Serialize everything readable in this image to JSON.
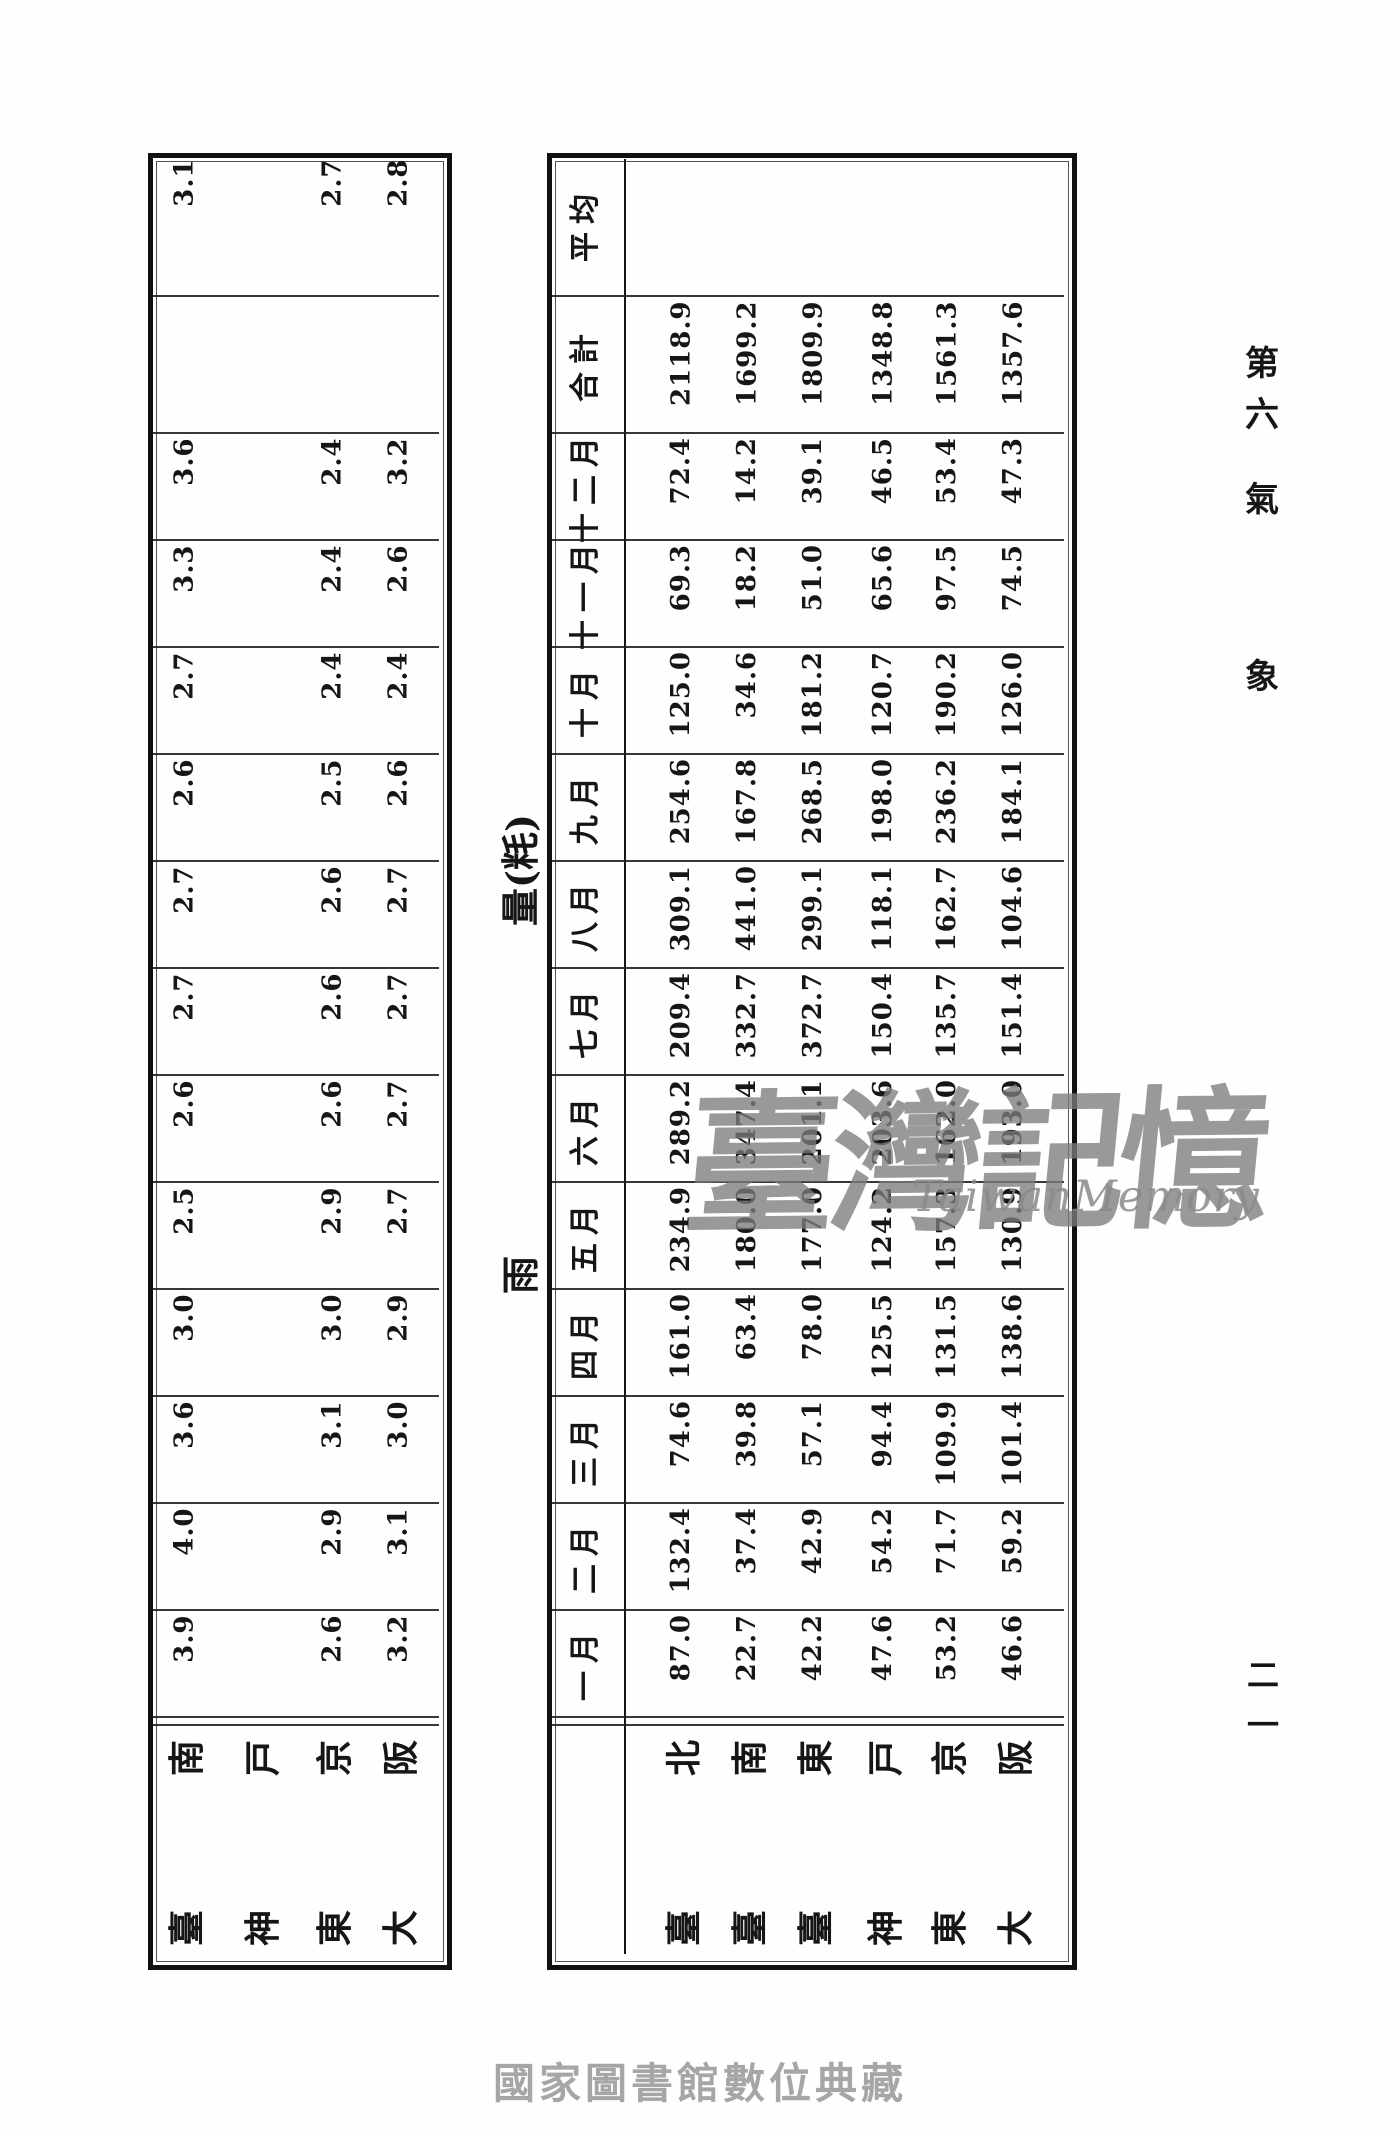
{
  "page": {
    "running_head": {
      "chars": [
        "第",
        "六",
        "氣",
        "象"
      ]
    },
    "page_number_chars": [
      "二",
      "一"
    ],
    "footer": "國家圖書館數位典藏",
    "watermark": {
      "cjk": "臺灣記憶",
      "latin": "TaiwanMemory"
    }
  },
  "section_title": {
    "lead": "雨",
    "unit": "量(粍)"
  },
  "row_labels": [
    "平均",
    "合計",
    "十二月",
    "十一月",
    "十月",
    "九月",
    "八月",
    "七月",
    "六月",
    "五月",
    "四月",
    "三月",
    "二月",
    "一月"
  ],
  "rain_table": {
    "cities": [
      [
        "臺",
        "北"
      ],
      [
        "臺",
        "南"
      ],
      [
        "臺",
        "東"
      ],
      [
        "神",
        "戸"
      ],
      [
        "東",
        "京"
      ],
      [
        "大",
        "阪"
      ]
    ],
    "values": [
      [
        "",
        "",
        "",
        "",
        "",
        ""
      ],
      [
        "2118.9",
        "1699.2",
        "1809.9",
        "1348.8",
        "1561.3",
        "1357.6"
      ],
      [
        "72.4",
        "14.2",
        "39.1",
        "46.5",
        "53.4",
        "47.3"
      ],
      [
        "69.3",
        "18.2",
        "51.0",
        "65.6",
        "97.5",
        "74.5"
      ],
      [
        "125.0",
        "34.6",
        "181.2",
        "120.7",
        "190.2",
        "126.0"
      ],
      [
        "254.6",
        "167.8",
        "268.5",
        "198.0",
        "236.2",
        "184.1"
      ],
      [
        "309.1",
        "441.0",
        "299.1",
        "118.1",
        "162.7",
        "104.6"
      ],
      [
        "209.4",
        "332.7",
        "372.7",
        "150.4",
        "135.7",
        "151.4"
      ],
      [
        "289.2",
        "347.4",
        "201.1",
        "203.6",
        "162.0",
        "193.0"
      ],
      [
        "234.9",
        "180.0",
        "177.0",
        "124.2",
        "157.3",
        "130.9"
      ],
      [
        "161.0",
        "63.4",
        "78.0",
        "125.5",
        "131.5",
        "138.6"
      ],
      [
        "74.6",
        "39.8",
        "57.1",
        "94.4",
        "109.9",
        "101.4"
      ],
      [
        "132.4",
        "37.4",
        "42.9",
        "54.2",
        "71.7",
        "59.2"
      ],
      [
        "87.0",
        "22.7",
        "42.2",
        "47.6",
        "53.2",
        "46.6"
      ]
    ]
  },
  "secondary_table": {
    "cities": [
      [
        "臺",
        "南"
      ],
      [
        "神",
        "戸"
      ],
      [
        "東",
        "京"
      ],
      [
        "大",
        "阪"
      ]
    ],
    "values": [
      [
        "3.1",
        "",
        "2.7",
        "2.8"
      ],
      [
        "",
        "",
        "",
        ""
      ],
      [
        "3.6",
        "",
        "2.4",
        "3.2"
      ],
      [
        "3.3",
        "",
        "2.4",
        "2.6"
      ],
      [
        "2.7",
        "",
        "2.4",
        "2.4"
      ],
      [
        "2.6",
        "",
        "2.5",
        "2.6"
      ],
      [
        "2.7",
        "",
        "2.6",
        "2.7"
      ],
      [
        "2.7",
        "",
        "2.6",
        "2.7"
      ],
      [
        "2.6",
        "",
        "2.6",
        "2.7"
      ],
      [
        "2.5",
        "",
        "2.9",
        "2.7"
      ],
      [
        "3.0",
        "",
        "3.0",
        "2.9"
      ],
      [
        "3.6",
        "",
        "3.1",
        "3.0"
      ],
      [
        "4.0",
        "",
        "2.9",
        "3.1"
      ],
      [
        "3.9",
        "",
        "2.6",
        "3.2"
      ]
    ]
  }
}
